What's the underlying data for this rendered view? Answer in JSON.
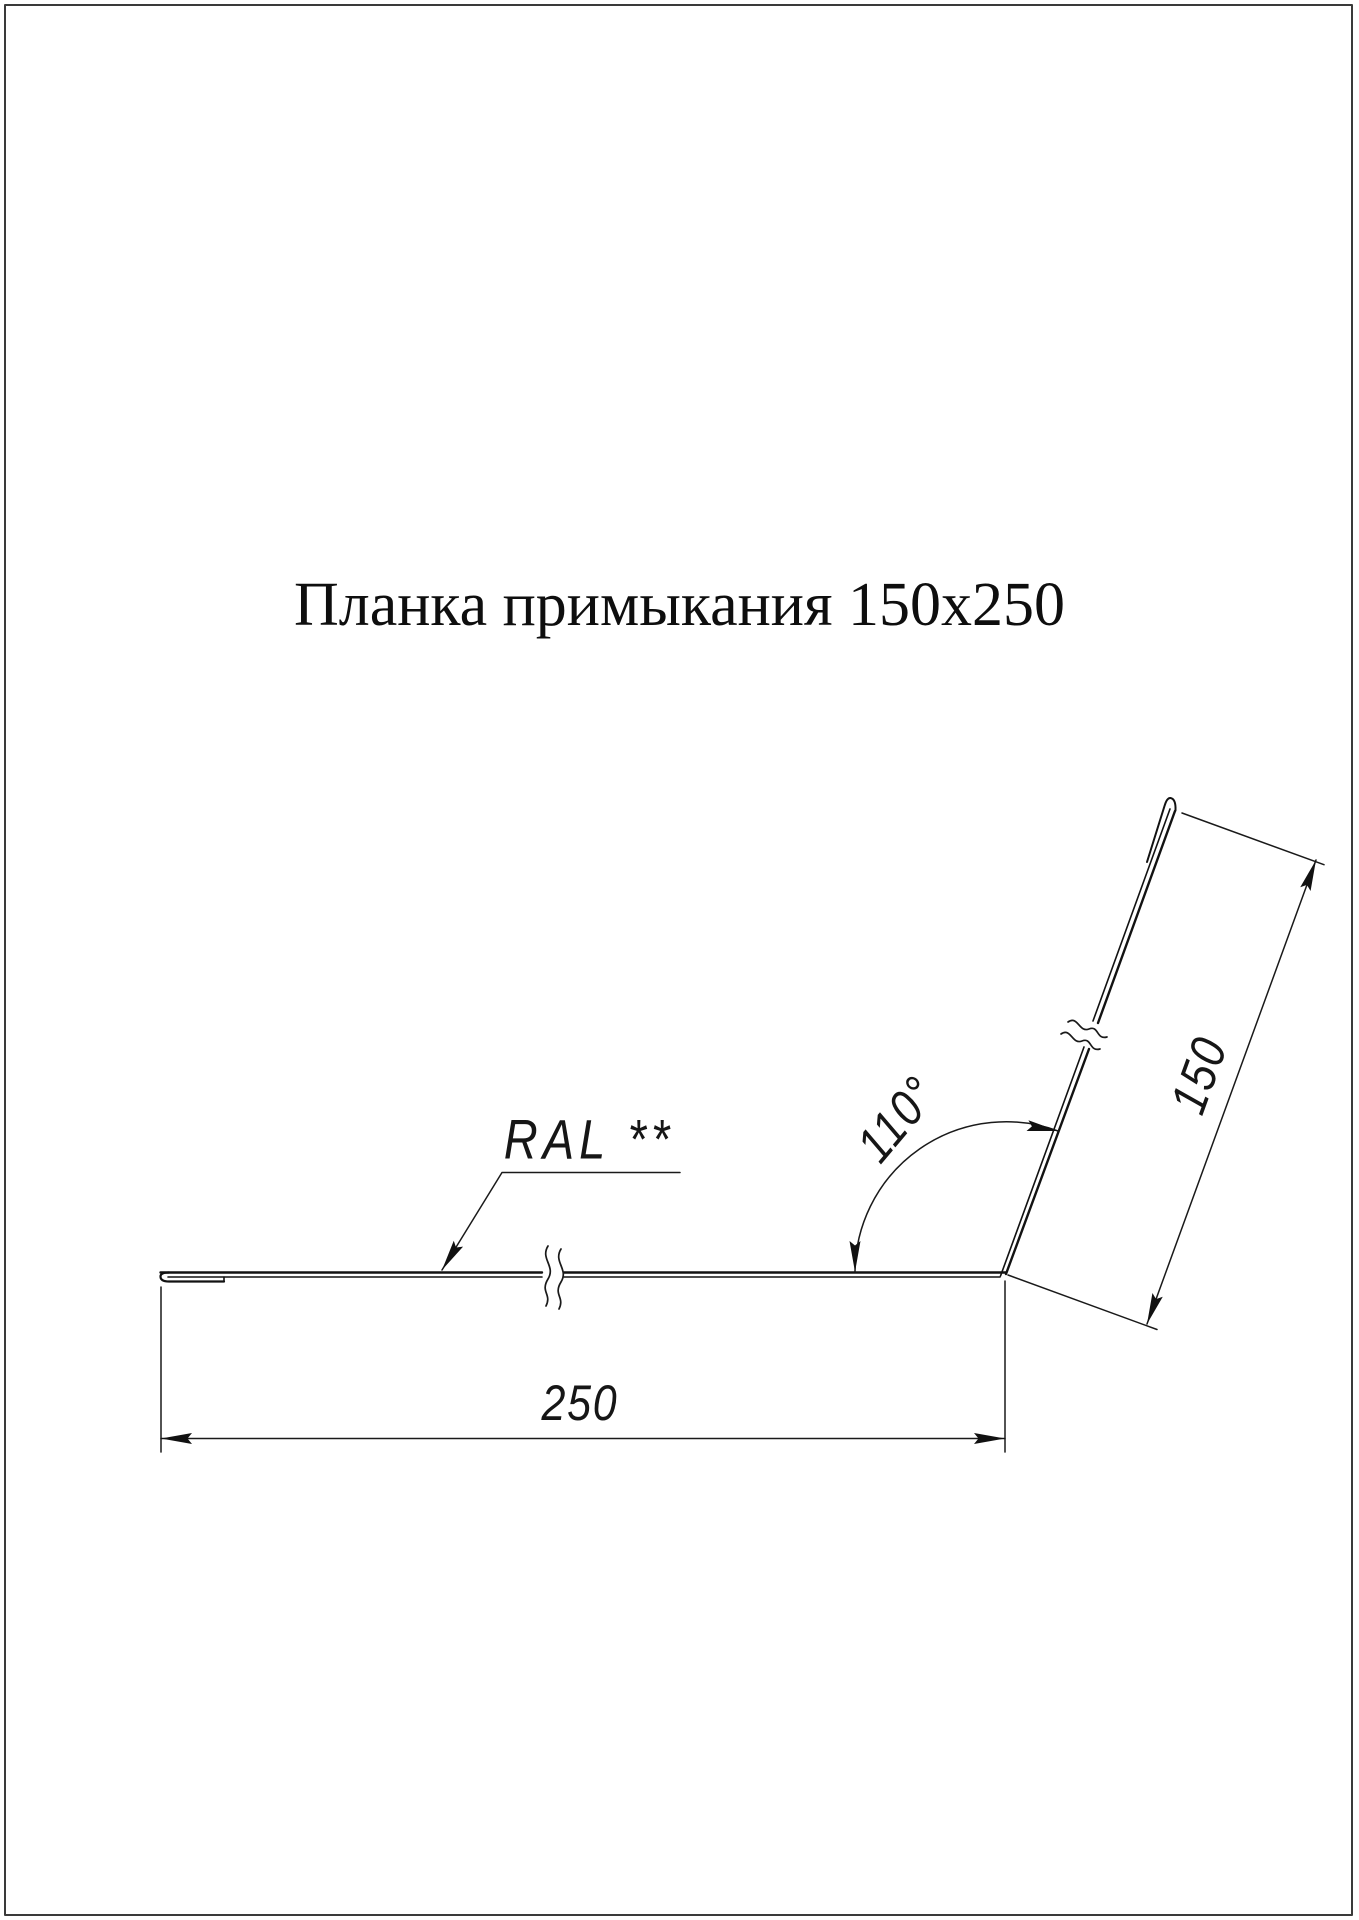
{
  "page": {
    "background": "#ffffff",
    "ink_color": "#151515",
    "frame_color": "#3a3a3a"
  },
  "title": {
    "text": "Планка примыкания 150x250"
  },
  "annotations": {
    "color_label": {
      "text": "RAL **"
    },
    "angle": {
      "text": "110°"
    },
    "flange_length": {
      "text": "150"
    },
    "base_length": {
      "text": "250"
    }
  }
}
